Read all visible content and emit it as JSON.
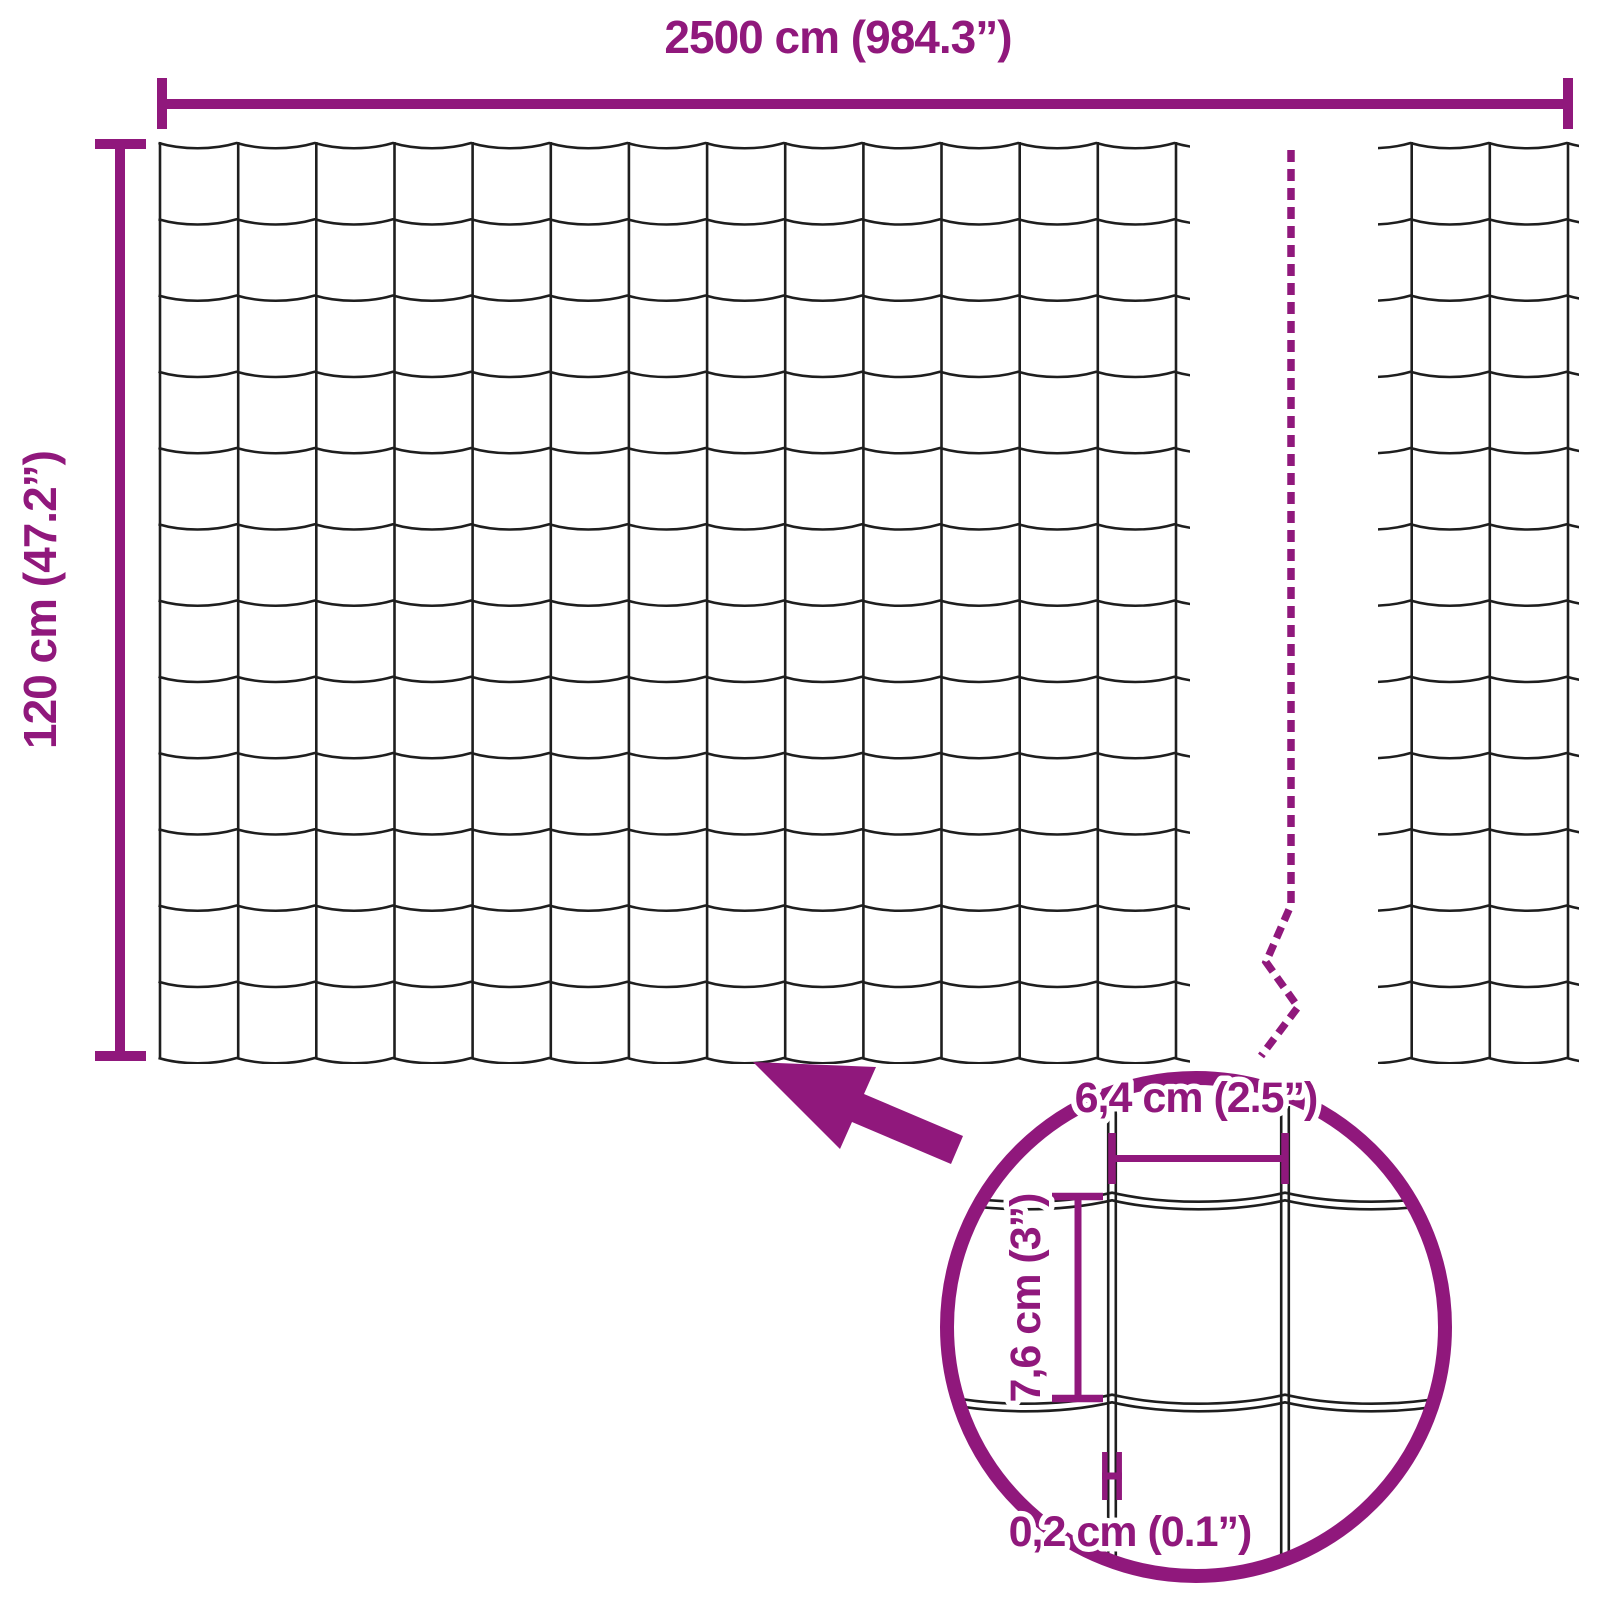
{
  "diagram": {
    "type": "wire-mesh-fence-dimension-diagram",
    "overall": {
      "width_label": "2500 cm (984.3”)",
      "height_label": "120 cm (47.2”)"
    },
    "detail": {
      "opening_width_label": "6,4 cm (2.5”)",
      "opening_height_label": "7,6 cm (3”)",
      "wire_thickness_label": "0,2 cm (0.1”)"
    },
    "mesh": {
      "main_columns": 13,
      "main_rows": 12,
      "continued_columns": 2,
      "zoom_vertical_wires": 2,
      "zoom_horizontal_wires": 2
    },
    "colors": {
      "accent": "#90187c",
      "wire": "#1e1e1e",
      "background": "#ffffff"
    }
  }
}
